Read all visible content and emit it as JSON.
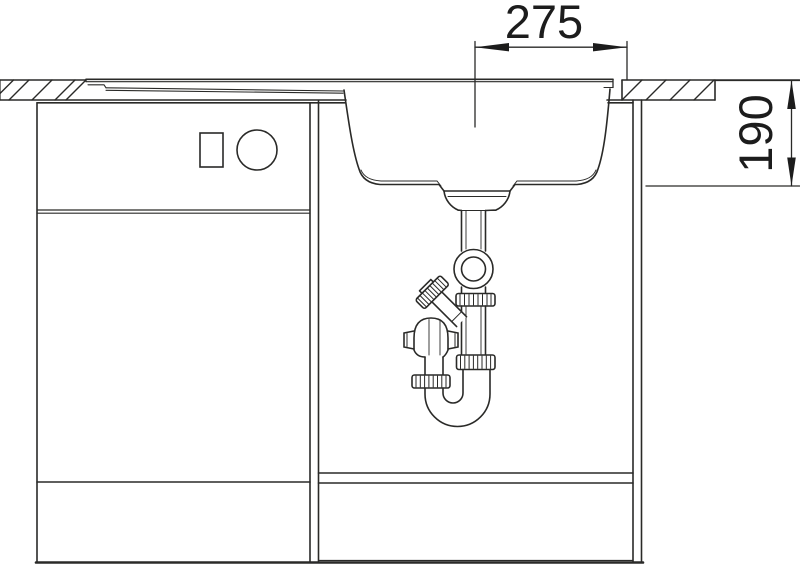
{
  "page": {
    "background": "#ffffff"
  },
  "drawing": {
    "type": "technical-line-drawing",
    "subject": "sink-and-cabinet-front-section-with-drain-trap",
    "line_color": "#2a2a28",
    "dim_horizontal": "275",
    "dim_vertical": "190"
  }
}
